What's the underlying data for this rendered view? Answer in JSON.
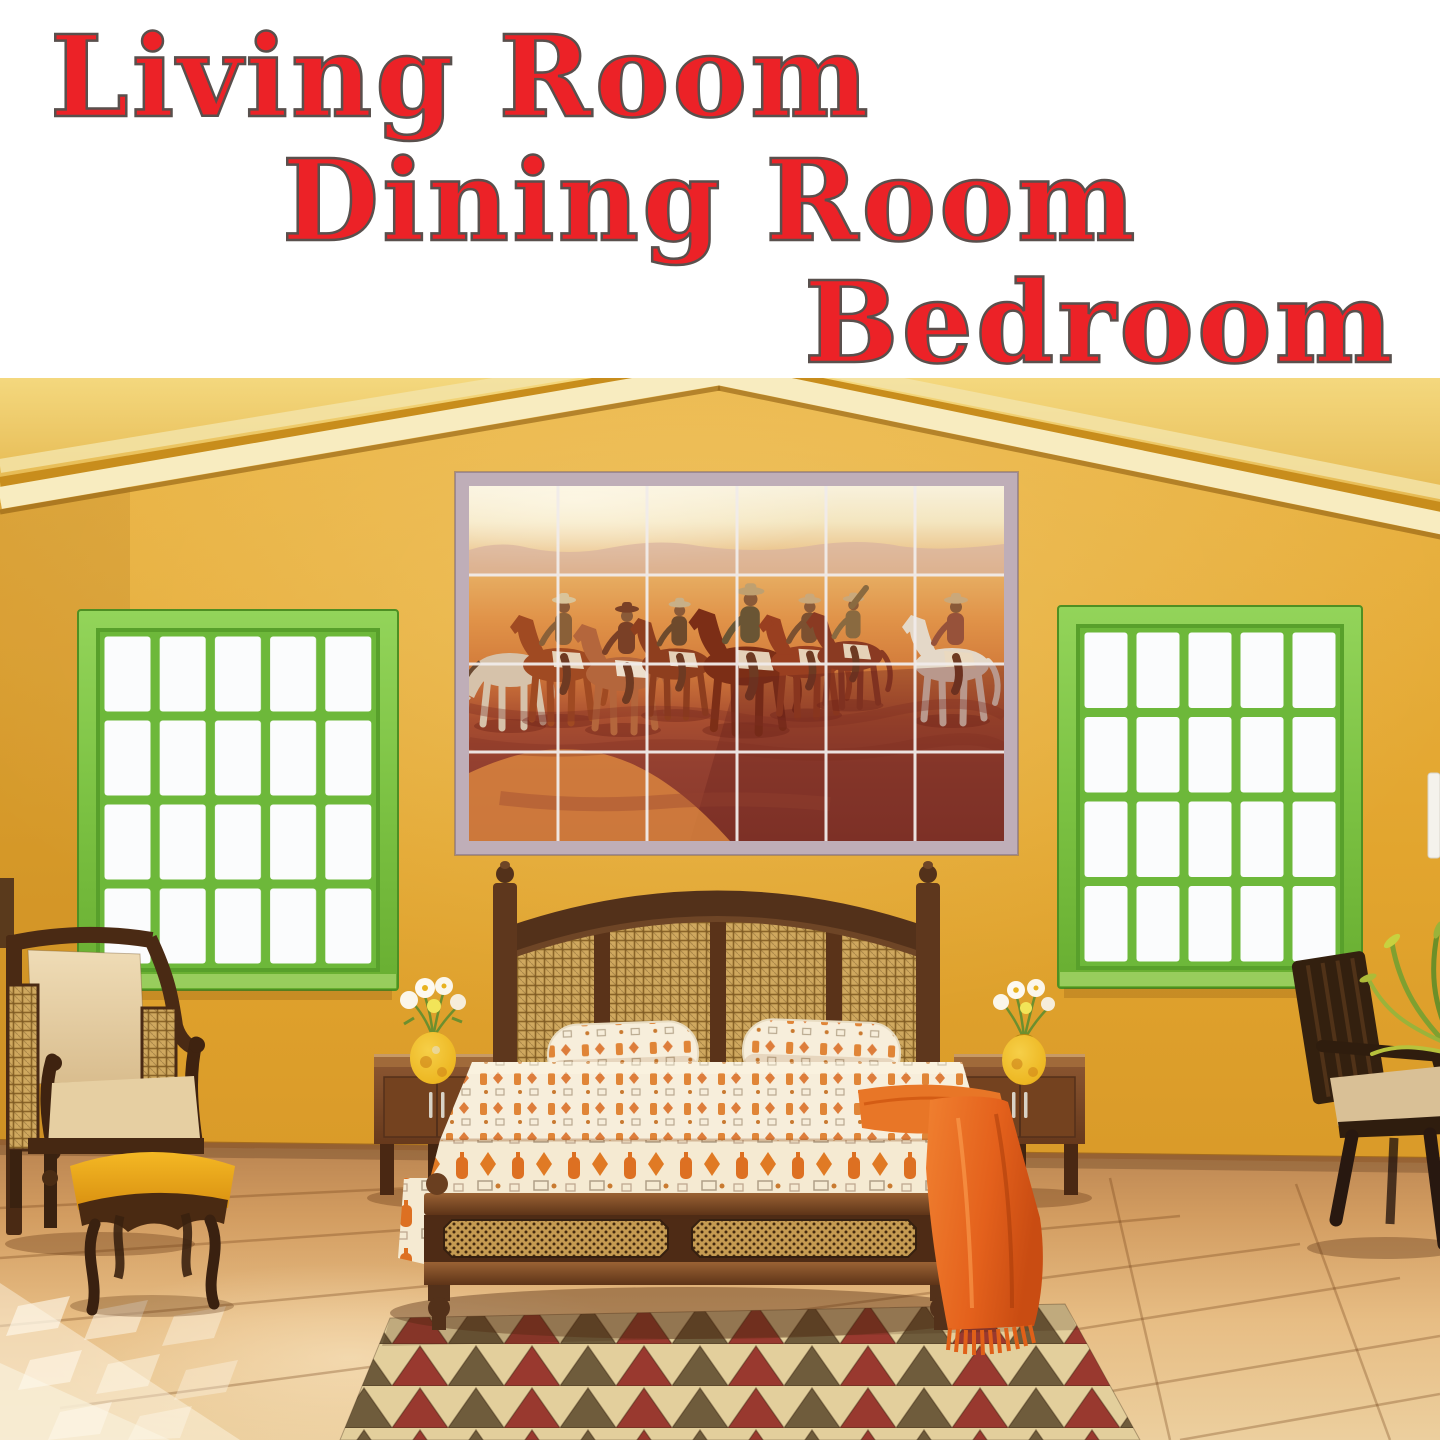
{
  "header": {
    "lines": [
      {
        "label": "Living Room"
      },
      {
        "label": "Dining Room"
      },
      {
        "label": "Bedroom"
      }
    ]
  },
  "palette": {
    "header_bg": "#ffffff",
    "header_red": "#ec2227",
    "header_outline": "#59504d",
    "wall_ochre": "#e2a52e",
    "ceiling_cream": "#f8ecc0",
    "window_green": "#7cc243",
    "pane_white": "#fbfcfd",
    "mural_frame_gray": "#bfaeb8",
    "mural_sky_cream": "#f8f1dc",
    "mural_prairie_orange": "#d47e3c",
    "mural_grass_maroon": "#87382c",
    "wood_dark": "#53311a",
    "cane_tan": "#c9a35c",
    "bedding_cream": "#f6ecd8",
    "motif_orange": "#dd7022",
    "throw_orange": "#e4611c",
    "floor_tan": "#dca96c",
    "rug_cream": "#e3cf9c",
    "rug_brown": "#6f5c3c",
    "rug_maroon": "#99392f",
    "stool_yellow": "#eaa71d",
    "vase_yellow": "#edb722",
    "flower_white": "#fbf6ea",
    "leaf_green": "#7fa030"
  },
  "scene": {
    "description": "Sunlit bedroom with ochre stucco walls and vaulted ceiling",
    "mural": {
      "subject": "western riders on horseback tile mural",
      "tile_columns": 6,
      "tile_rows": 4,
      "rider_count": 8
    },
    "windows": [
      {
        "name": "left-window",
        "pane_columns": 5,
        "pane_rows": 4
      },
      {
        "name": "right-window",
        "pane_columns": 5,
        "pane_rows": 4
      }
    ],
    "furniture": [
      "cane headboard bed with patterned bedspread",
      "two bolster pillows",
      "orange throw blanket",
      "left nightstand with yellow flower vase",
      "right nightstand with yellow flower vase",
      "upholstered armchair with cane sides",
      "yellow footstool",
      "dark wood side chair",
      "triangle pattern area rug",
      "potted plant"
    ]
  }
}
